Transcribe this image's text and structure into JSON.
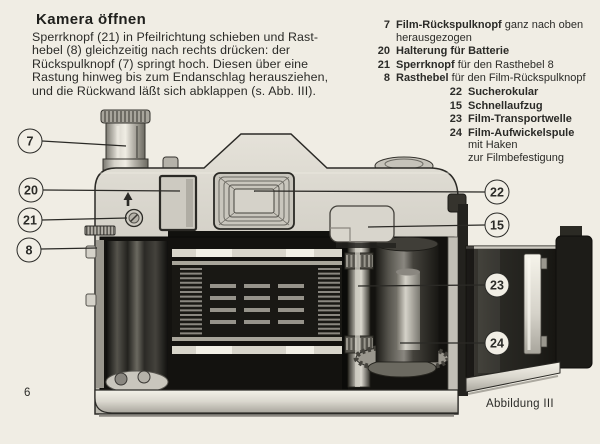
{
  "page": {
    "title": "Kamera öffnen",
    "body_text": "Sperrknopf (21) in Pfeilrichtung schieben und Rast-\nhebel (8) gleichzeitig nach rechts drücken: der\nRückspulknopf (7) springt hoch. Diesen über eine\nRastung hinweg bis zum Endanschlag herausziehen,\nund die Rückwand läßt sich abklappen (s. Abb. III).",
    "page_number": "6",
    "figure_caption": "Abbildung III"
  },
  "legend": {
    "items": [
      {
        "num": "7",
        "bold": "Film-Rückspulknopf",
        "rest": " ganz nach oben\nherausgezogen"
      },
      {
        "num": "20",
        "bold": "Halterung für Batterie",
        "rest": ""
      },
      {
        "num": "21",
        "bold": "Sperrknopf",
        "rest": " für den Rasthebel 8"
      },
      {
        "num": "8",
        "bold": "Rasthebel",
        "rest": " für den Film-Rückspulknopf"
      },
      {
        "num": "22",
        "bold": "Sucherokular",
        "rest": ""
      },
      {
        "num": "15",
        "bold": "Schnellaufzug",
        "rest": ""
      },
      {
        "num": "23",
        "bold": "Film-Transportwelle",
        "rest": ""
      },
      {
        "num": "24",
        "bold": "Film-Aufwickelspule",
        "rest": "\nmit Haken\nzur Filmbefestigung"
      }
    ]
  },
  "callouts": {
    "c7": "7",
    "c20": "20",
    "c21": "21",
    "c8": "8",
    "c22": "22",
    "c15": "15",
    "c23": "23",
    "c24": "24"
  },
  "colors": {
    "page_background": "#f0ede4",
    "ink": "#2b2b28",
    "diagram_dark": "#14130f",
    "diagram_light": "#d8d5cc"
  }
}
